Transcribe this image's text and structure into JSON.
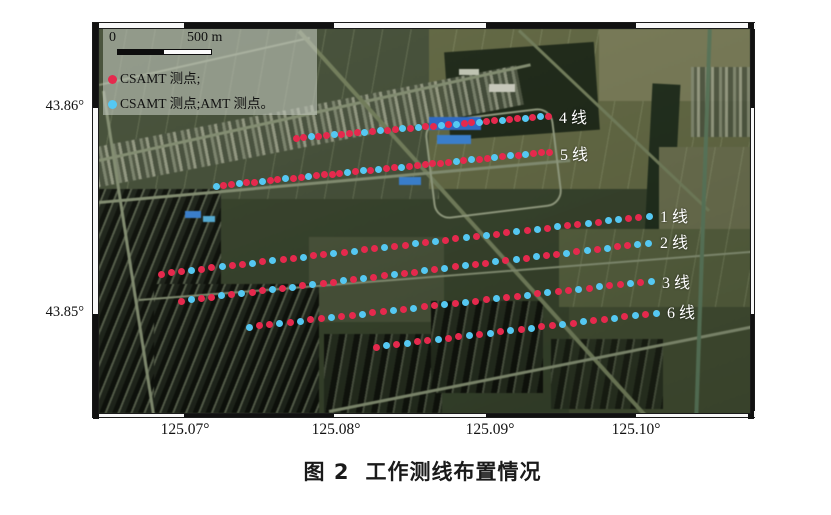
{
  "figure": {
    "caption_label": "图 2",
    "caption_title": "工作测线布置情况"
  },
  "map": {
    "frame": {
      "thickness": 6,
      "x_bounds": [
        0,
        91,
        241,
        393,
        543,
        663
      ],
      "x_colors": [
        "#f8f8f8",
        "#111111",
        "#f8f8f8",
        "#111111",
        "#f8f8f8"
      ],
      "y_bounds": [
        0,
        85,
        291,
        396
      ],
      "y_colors": [
        "#111111",
        "#f8f8f8",
        "#111111"
      ]
    },
    "axes": {
      "x_ticks": [
        {
          "label": "125.07°",
          "x": 93
        },
        {
          "label": "125.08°",
          "x": 244
        },
        {
          "label": "125.09°",
          "x": 398
        },
        {
          "label": "125.10°",
          "x": 544
        }
      ],
      "y_ticks": [
        {
          "label": "43.86°",
          "y": 85
        },
        {
          "label": "43.85°",
          "y": 291
        }
      ]
    },
    "legend": {
      "scale_zero": "0",
      "scale_label": "500 m",
      "items": [
        {
          "color": "#e5294d",
          "label": "CSAMT 测点;"
        },
        {
          "color": "#55c8f2",
          "label": "CSAMT 测点;AMT 测点。"
        }
      ]
    },
    "point_colors": {
      "r": "#e5294d",
      "c": "#55c8f2"
    },
    "survey_lines": [
      {
        "label": "4 线",
        "x1": 197,
        "y1": 109,
        "x2": 449,
        "y2": 87,
        "lx": 460,
        "ly": 87,
        "pattern": "rrcrrcrrrcrcrrcrcrrcrcrrcrrcrrcrcr"
      },
      {
        "label": "5 线",
        "x1": 117,
        "y1": 157,
        "x2": 450,
        "y2": 123,
        "lx": 461,
        "ly": 124,
        "pattern": "crrcrrcrrcrrcrrrrcrcrcrrcrrrrrrcrcrrcrcrcrrr"
      },
      {
        "label": "1 线",
        "x1": 62,
        "y1": 245,
        "x2": 550,
        "y2": 187,
        "lx": 561,
        "ly": 186,
        "pattern": "rrrcrrcrrcrcrrcrrcrcrrcrrcrcrrcrcrrcrcrcrrcrccrrc"
      },
      {
        "label": "2 线",
        "x1": 82,
        "y1": 272,
        "x2": 549,
        "y2": 214,
        "lx": 561,
        "ly": 212,
        "pattern": "rcrrcrcrrcrcrcrrcrcrrcrrcrcrcrrcrcrcrrcrcrcrrcc"
      },
      {
        "label": "3 线",
        "x1": 150,
        "y1": 298,
        "x2": 552,
        "y2": 252,
        "lx": 563,
        "ly": 252,
        "pattern": "crrcrcrrcrrcrrcrcrrcrcrrcrrcrcrrcrcrrcrc"
      },
      {
        "label": "6 线",
        "x1": 277,
        "y1": 318,
        "x2": 557,
        "y2": 284,
        "lx": 568,
        "ly": 282,
        "pattern": "rcrcrrcrrcrcrcrcrrcrcrrcrcrc"
      }
    ]
  }
}
